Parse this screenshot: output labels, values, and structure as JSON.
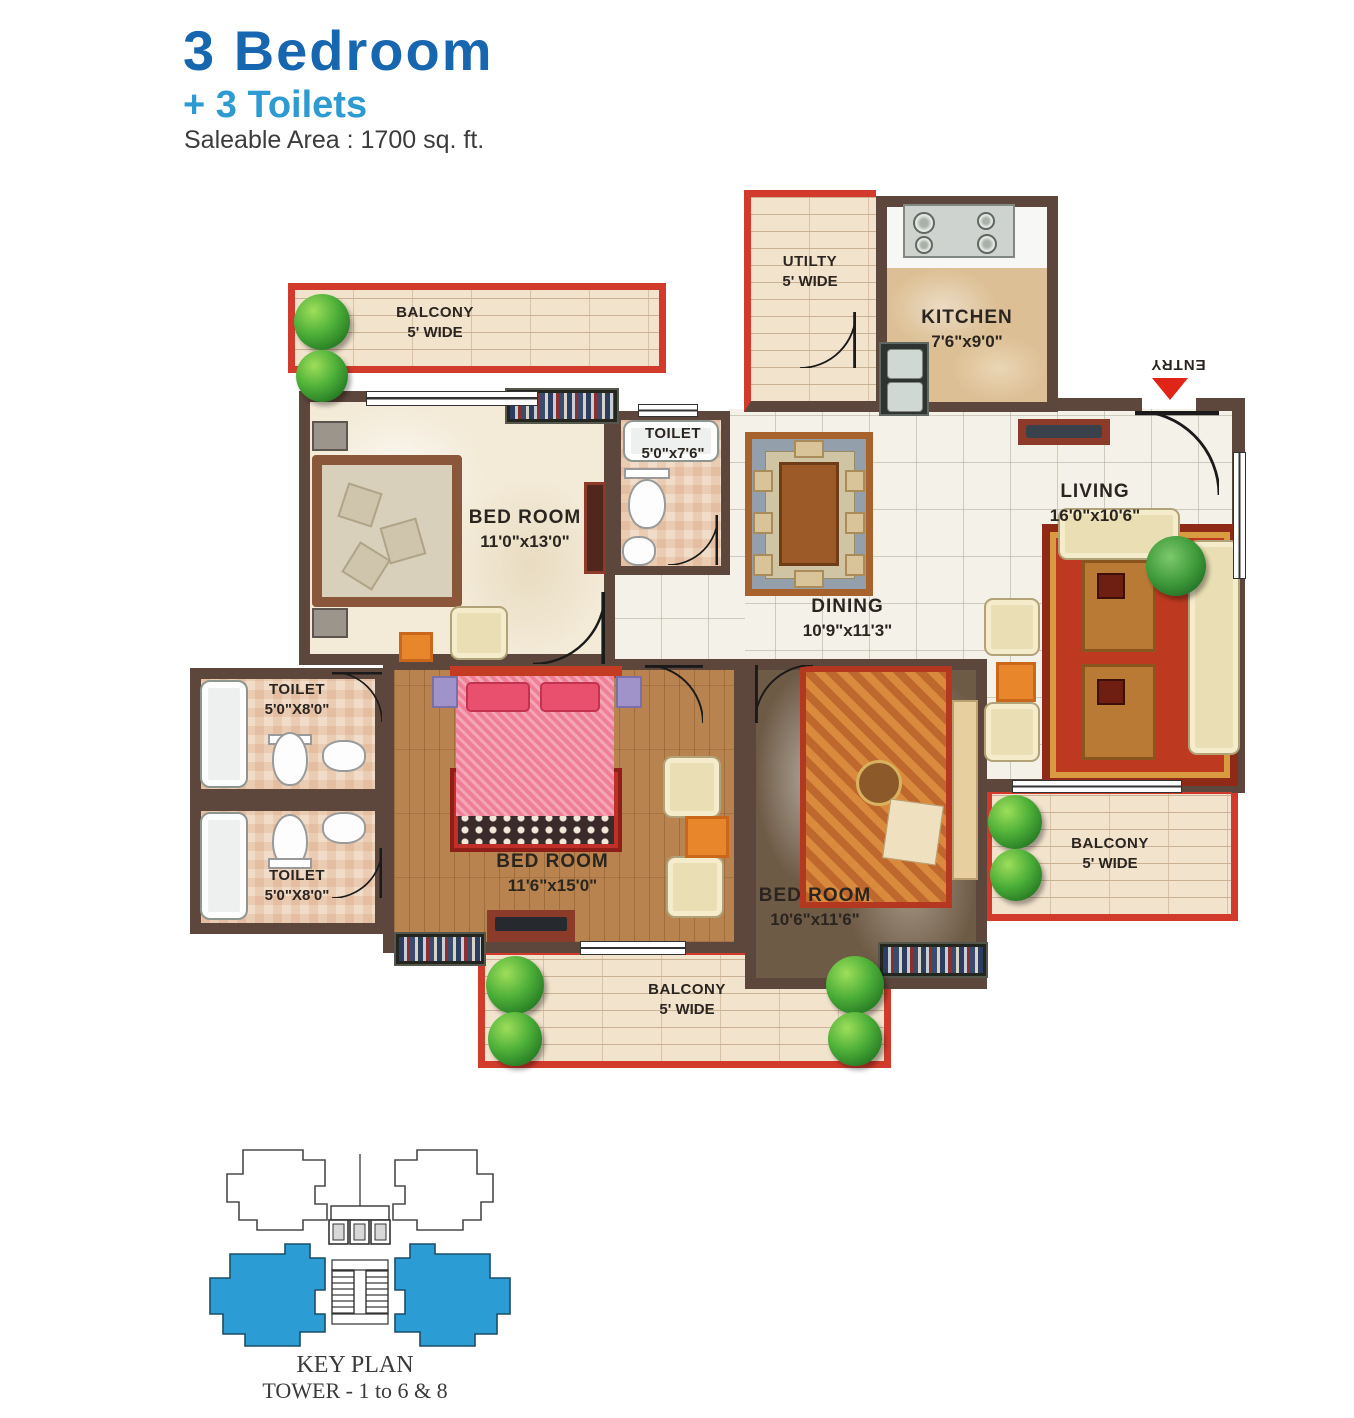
{
  "header": {
    "title": "3 Bedroom",
    "subtitle": "+ 3 Toilets",
    "area": "Saleable Area : 1700 sq. ft."
  },
  "plan": {
    "balcony_top_left": {
      "label": "BALCONY",
      "size": "5' WIDE"
    },
    "bedroom_1": {
      "label": "BED ROOM",
      "size": "11'0\"x13'0\""
    },
    "toilet_1": {
      "label": "TOILET",
      "size": "5'0\"x7'6\""
    },
    "utility": {
      "label": "UTILTY",
      "size": "5' WIDE"
    },
    "kitchen": {
      "label": "KITCHEN",
      "size": "7'6\"x9'0\""
    },
    "living": {
      "label": "LIVING",
      "size": "16'0\"x10'6\""
    },
    "dining": {
      "label": "DINING",
      "size": "10'9\"x11'3\""
    },
    "toilet_2": {
      "label": "TOILET",
      "size": "5'0\"X8'0\""
    },
    "toilet_3": {
      "label": "TOILET",
      "size": "5'0\"X8'0\""
    },
    "bedroom_2": {
      "label": "BED ROOM",
      "size": "11'6\"x15'0\""
    },
    "bedroom_3": {
      "label": "BED ROOM",
      "size": "10'6\"x11'6\""
    },
    "balcony_right": {
      "label": "BALCONY",
      "size": "5' WIDE"
    },
    "balcony_bottom": {
      "label": "BALCONY",
      "size": "5' WIDE"
    },
    "entry_label": "ENTRY"
  },
  "keyplan": {
    "title": "KEY PLAN",
    "subtitle": "TOWER - 1 to 6 & 8"
  },
  "colors": {
    "title_blue": "#1766b0",
    "subtitle_blue": "#2d9ad2",
    "wall_brown": "#5d463b",
    "balcony_red": "#d23b2c",
    "entry_red": "#e02417",
    "keyplan_blue": "#2b9cd4"
  }
}
